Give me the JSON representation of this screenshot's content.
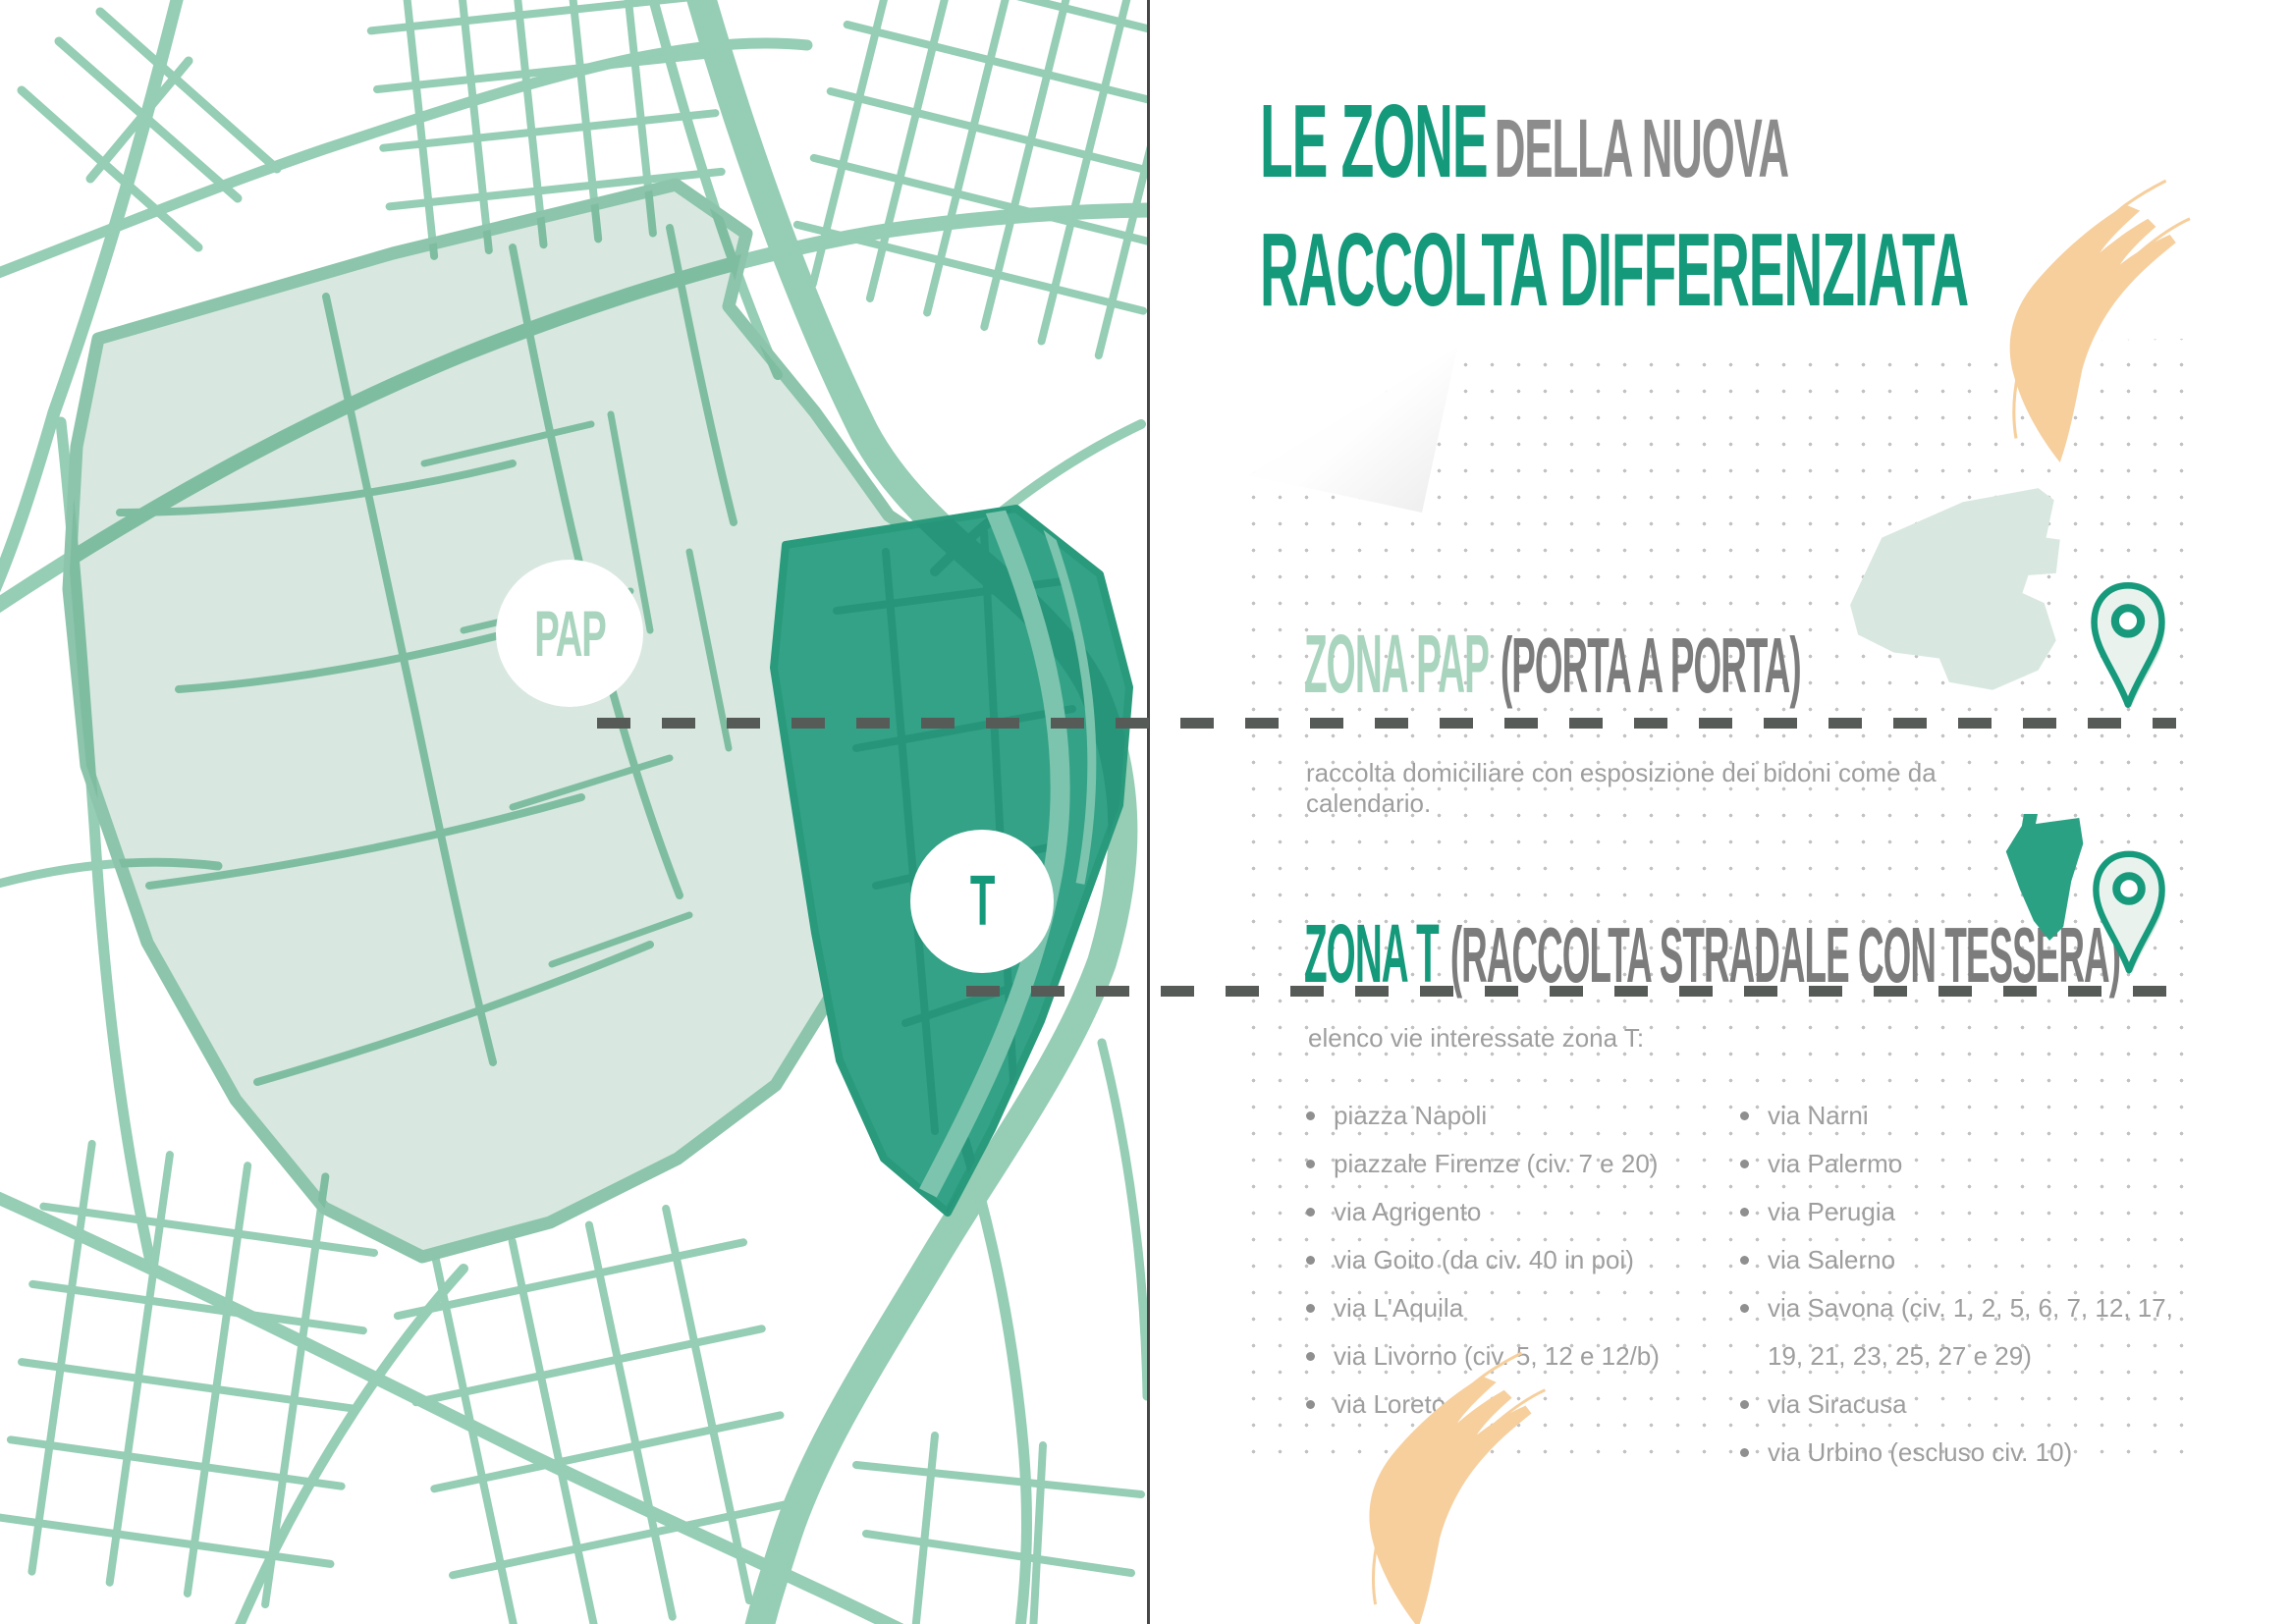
{
  "page": {
    "title_part1": "LE ZONE",
    "title_part2": "DELLA NUOVA",
    "title_line2": "RACCOLTA DIFFERENZIATA"
  },
  "map": {
    "pap_badge": "PAP",
    "t_badge": "T"
  },
  "panel": {
    "pap": {
      "name": "ZONA PAP",
      "type": "(PORTA A PORTA)",
      "description": "raccolta domiciliare con esposizione dei bidoni come da calendario."
    },
    "t": {
      "name": "ZONA T",
      "type": "(RACCOLTA STRADALE CON TESSERA)",
      "list_intro": "elenco vie interessate zona T:",
      "streets_col1": [
        "piazza Napoli",
        "piazzale Firenze (civ. 7 e 20)",
        "via Agrigento",
        "via Goito (da civ. 40 in poi)",
        "via L'Aquila",
        "via Livorno (civ. 5, 12 e 12/b)",
        "via Loreto"
      ],
      "streets_col2": [
        "via Narni",
        "via Palermo",
        "via Perugia",
        "via Salerno",
        "via Savona (civ. 1, 2, 5, 6, 7, 12, 17, 19, 21, 23, 25, 27 e 29)",
        "via Siracusa",
        "via Urbino (escluso civ. 10)"
      ]
    }
  },
  "colors": {
    "accent_teal": "#14997b",
    "zone_pap_light": "#a9d4be",
    "street_green": "#95cdb5",
    "zone_pap_fill": "#d8e8e0",
    "zone_t_fill": "#33a287",
    "hand_orange": "#f6cf9d",
    "text_gray": "#9e9e9e",
    "title_gray": "#8c8c8c",
    "dash_gray": "#575b58"
  }
}
